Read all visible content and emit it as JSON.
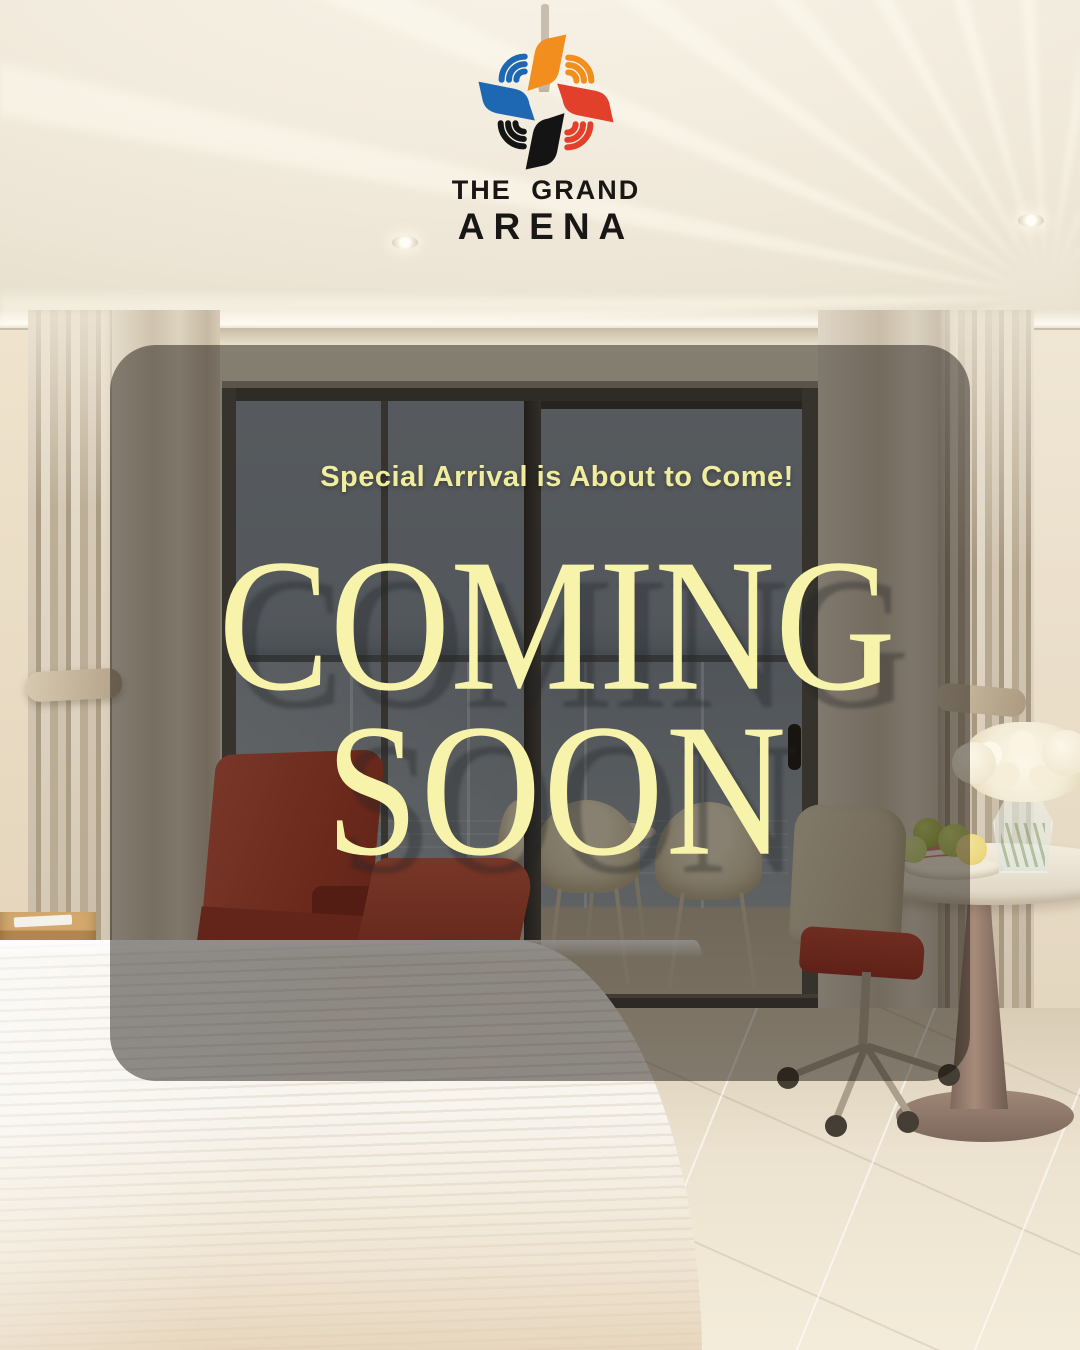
{
  "brand": {
    "wordmark_line1": "THE GRAND",
    "wordmark_line2": "ARENA",
    "logo_petal_colors": {
      "top": "#F28E1E",
      "right": "#E2402B",
      "bottom": "#141414",
      "left": "#1E68B3"
    }
  },
  "announcement": {
    "tagline": "Special Arrival is About to Come!",
    "headline_line1": "COMING",
    "headline_line2": "SOON",
    "text_color": "#F5F1A6",
    "panel_color": "rgba(15,11,7,0.46)"
  },
  "scene": {
    "alt": "Hotel guest room with sea-view balcony, red armchair, white bed, desk chair and side table with white roses and green apples"
  }
}
